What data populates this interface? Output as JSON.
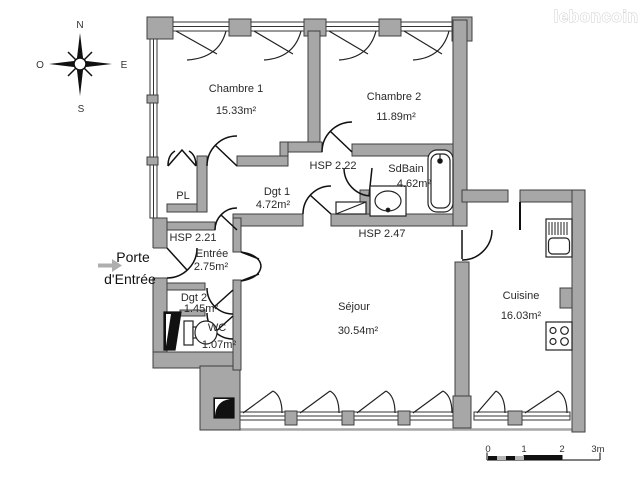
{
  "brand": {
    "logo_text": "leboncoin"
  },
  "compass": {
    "north": "N",
    "south": "S",
    "east": "E",
    "west": "O"
  },
  "entrance_callout": {
    "line1": "Porte",
    "line2": "d'Entrée"
  },
  "rooms": {
    "chambre1": {
      "name": "Chambre 1",
      "area": "15.33m²"
    },
    "chambre2": {
      "name": "Chambre 2",
      "area": "11.89m²"
    },
    "sdbain": {
      "name": "SdBain",
      "area": "4.62m²"
    },
    "dgt1": {
      "name": "Dgt 1",
      "area": "4.72m²"
    },
    "pl": {
      "name": "PL"
    },
    "entree": {
      "name": "Entrée",
      "area": "2.75m²"
    },
    "dgt2": {
      "name": "Dgt 2",
      "area": "1.45m²"
    },
    "wc": {
      "name": "WC",
      "area": "1.07m²"
    },
    "sejour": {
      "name": "Séjour",
      "area": "30.54m²"
    },
    "cuisine": {
      "name": "Cuisine",
      "area": "16.03m²"
    }
  },
  "ceiling_heights": {
    "hsp_corridor": "HSP 2.22",
    "hsp_entry": "HSP 2.21",
    "hsp_sejour_edge": "HSP 2.47"
  },
  "scale_bar": {
    "tick_0": "0",
    "tick_1": "1",
    "tick_2": "2",
    "tick_3": "3m"
  },
  "colors": {
    "wall_fill": "#a7a7a7",
    "wall_stroke": "#3f3f3f",
    "line": "#1d1d1d",
    "text": "#2a2a2a",
    "arrow_gray": "#aeaeae",
    "logo_outline": "#c8c8c8"
  }
}
